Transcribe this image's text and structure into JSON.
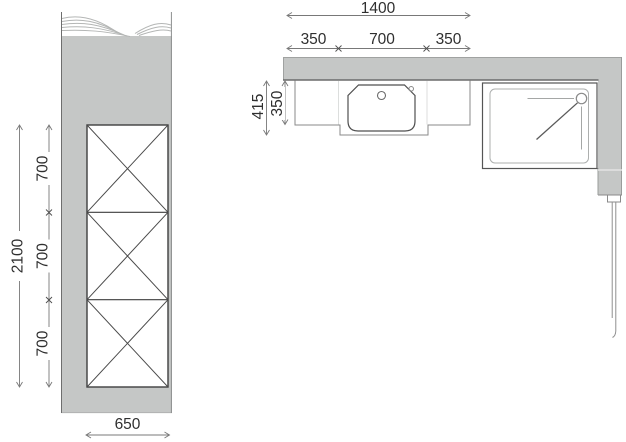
{
  "left_elevation": {
    "dim_total_height": "2100",
    "dim_segments": [
      "700",
      "700",
      "700"
    ],
    "dim_width": "650"
  },
  "right_plan": {
    "dim_total_width": "1400",
    "dim_segments": [
      "350",
      "700",
      "350"
    ],
    "dim_depth_overall": "415",
    "dim_depth_counter": "350"
  },
  "colors": {
    "wall_fill": "#c5c7c6",
    "unit_outline": "#3f3f3f",
    "fixture_outline": "#8a8a8a",
    "dim_line": "#787878",
    "text_color": "#2f2f2f",
    "background": "#ffffff"
  }
}
